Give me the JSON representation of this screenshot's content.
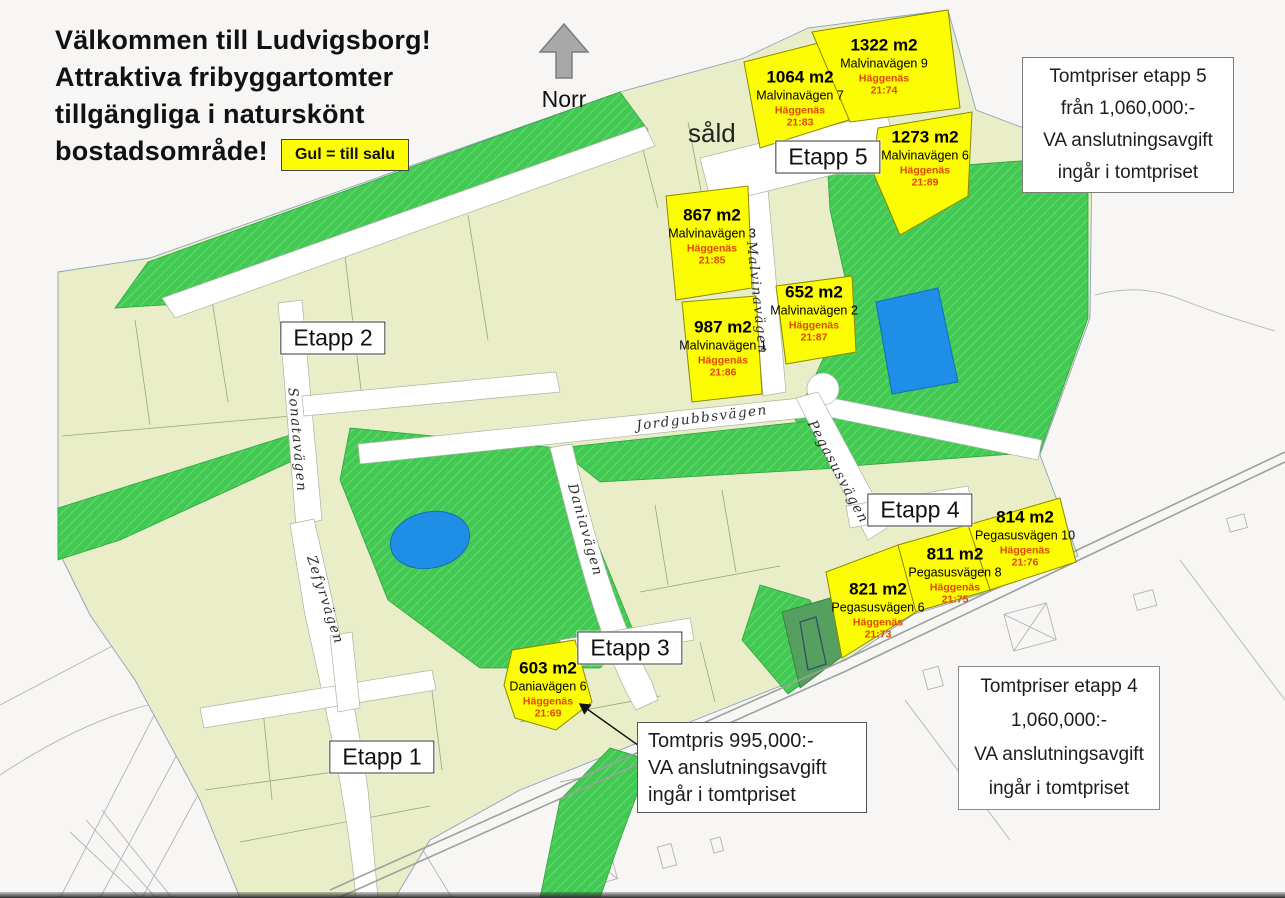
{
  "header": {
    "title_lines": [
      "Välkommen till Ludvigsborg!",
      "Attraktiva fribyggartomter",
      "tillgängliga i naturskönt",
      "bostadsområde!"
    ],
    "legend_label": "Gul = till salu",
    "north_label": "Norr"
  },
  "boxes": {
    "etapp5": {
      "lines": [
        "Tomtpriser etapp 5",
        "från 1,060,000:-",
        "VA anslutningsavgift",
        "ingår i tomtpriset"
      ]
    },
    "etapp4": {
      "lines": [
        "Tomtpriser etapp 4",
        "1,060,000:-",
        "VA anslutningsavgift",
        "ingår i tomtpriset"
      ]
    },
    "tomtpris": {
      "lines": [
        "Tomtpris 995,000:-",
        "VA anslutningsavgift",
        "ingår i tomtpriset"
      ]
    }
  },
  "map": {
    "stage_labels": [
      "Etapp 1",
      "Etapp 2",
      "Etapp 3",
      "Etapp 4",
      "Etapp 5"
    ],
    "sold_label": "såld",
    "streets": [
      "Sonatavägen",
      "Zefyrvägen",
      "Daniavägen",
      "Jordgubbsvägen",
      "Malvinavägen",
      "Pegasusvägen"
    ],
    "plots": [
      {
        "area": "1064 m2",
        "address": "Malvinavägen 7",
        "municipality": "Häggenäs",
        "parcel": "21:83"
      },
      {
        "area": "1322 m2",
        "address": "Malvinavägen 9",
        "municipality": "Häggenäs",
        "parcel": "21:74"
      },
      {
        "area": "1273 m2",
        "address": "Malvinavägen 6",
        "municipality": "Häggenäs",
        "parcel": "21:89"
      },
      {
        "area": "867 m2",
        "address": "Malvinavägen 3",
        "municipality": "Häggenäs",
        "parcel": "21:85"
      },
      {
        "area": "652 m2",
        "address": "Malvinavägen 2",
        "municipality": "Häggenäs",
        "parcel": "21:87"
      },
      {
        "area": "987 m2",
        "address": "Malvinavägen 1",
        "municipality": "Häggenäs",
        "parcel": "21:86"
      },
      {
        "area": "814 m2",
        "address": "Pegasusvägen 10",
        "municipality": "Häggenäs",
        "parcel": "21:76"
      },
      {
        "area": "811 m2",
        "address": "Pegasusvägen 8",
        "municipality": "Häggenäs",
        "parcel": "21:75"
      },
      {
        "area": "821 m2",
        "address": "Pegasusvägen 6",
        "municipality": "Häggenäs",
        "parcel": "21:73"
      },
      {
        "area": "603 m2",
        "address": "Daniavägen 6",
        "municipality": "Häggenäs",
        "parcel": "21:69"
      }
    ]
  },
  "colors": {
    "c-yellow": "#fcfc05",
    "c-green": "#41c952",
    "c-green-dark": "#56a05f",
    "c-khaki": "#e9eec9",
    "c-water": "#1e8ee6",
    "c-road": "#ffffff",
    "c-red-text": "#e04800",
    "c-bg": "#f7f6f4"
  }
}
